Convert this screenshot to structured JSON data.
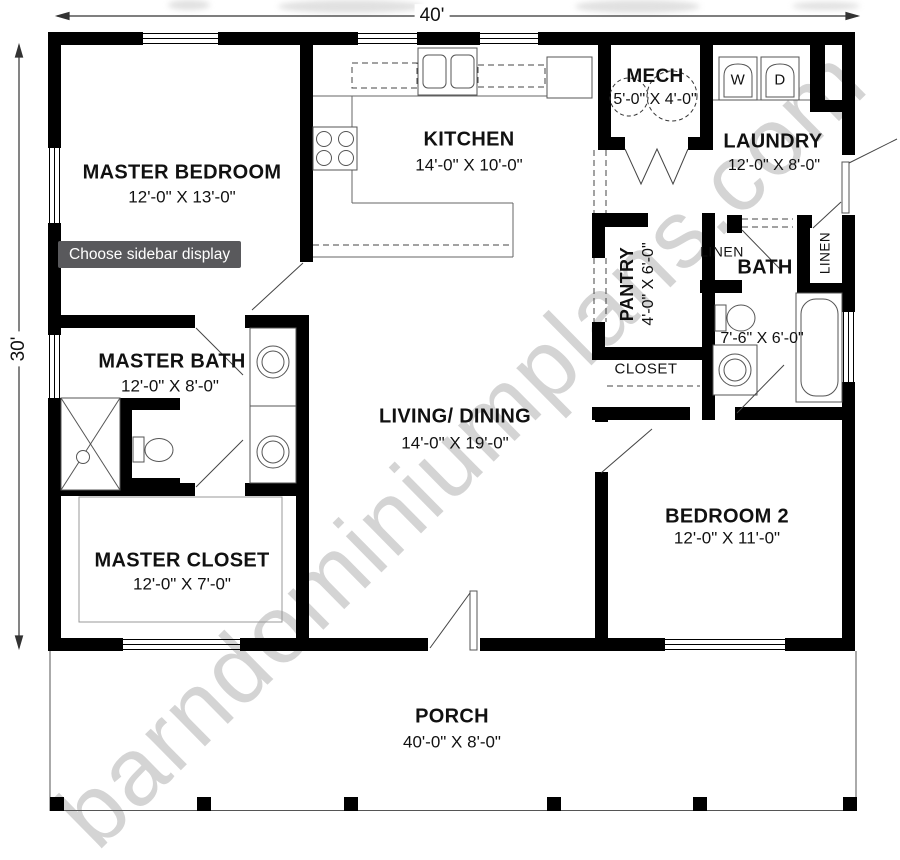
{
  "watermark": "barndominiumplans.com",
  "tooltip": "Choose sidebar display",
  "dimensions": {
    "overall_width": "40'",
    "overall_height": "30'"
  },
  "appliances": {
    "washer": "W",
    "dryer": "D"
  },
  "rooms": {
    "master_bedroom": {
      "name": "MASTER BEDROOM",
      "dims": "12'-0\" X 13'-0\""
    },
    "kitchen": {
      "name": "KITCHEN",
      "dims": "14'-0\" X 10'-0\""
    },
    "mech": {
      "name": "MECH",
      "dims": "5'-0\" X 4'-0\""
    },
    "laundry": {
      "name": "LAUNDRY",
      "dims": "12'-0\" X 8'-0\""
    },
    "pantry": {
      "name": "PANTRY",
      "dims": "4'-0\" X 6'-0\""
    },
    "linen_left": {
      "name": "LINEN"
    },
    "linen_right": {
      "name": "LINEN"
    },
    "bath": {
      "name": "BATH",
      "dims": "7'-6\" X 6'-0\""
    },
    "closet": {
      "name": "CLOSET"
    },
    "living_dining": {
      "name": "LIVING/ DINING",
      "dims": "14'-0\" X 19'-0\""
    },
    "master_bath": {
      "name": "MASTER BATH",
      "dims": "12'-0\" X 8'-0\""
    },
    "master_closet": {
      "name": "MASTER CLOSET",
      "dims": "12'-0\" X 7'-0\""
    },
    "bedroom_2": {
      "name": "BEDROOM 2",
      "dims": "12'-0\" X 11'-0\""
    },
    "porch": {
      "name": "PORCH",
      "dims": "40'-0\" X 8'-0\""
    }
  },
  "colors": {
    "wall": "#000000",
    "watermark": "#cdcdcd",
    "tooltip_bg": "#59595c"
  }
}
